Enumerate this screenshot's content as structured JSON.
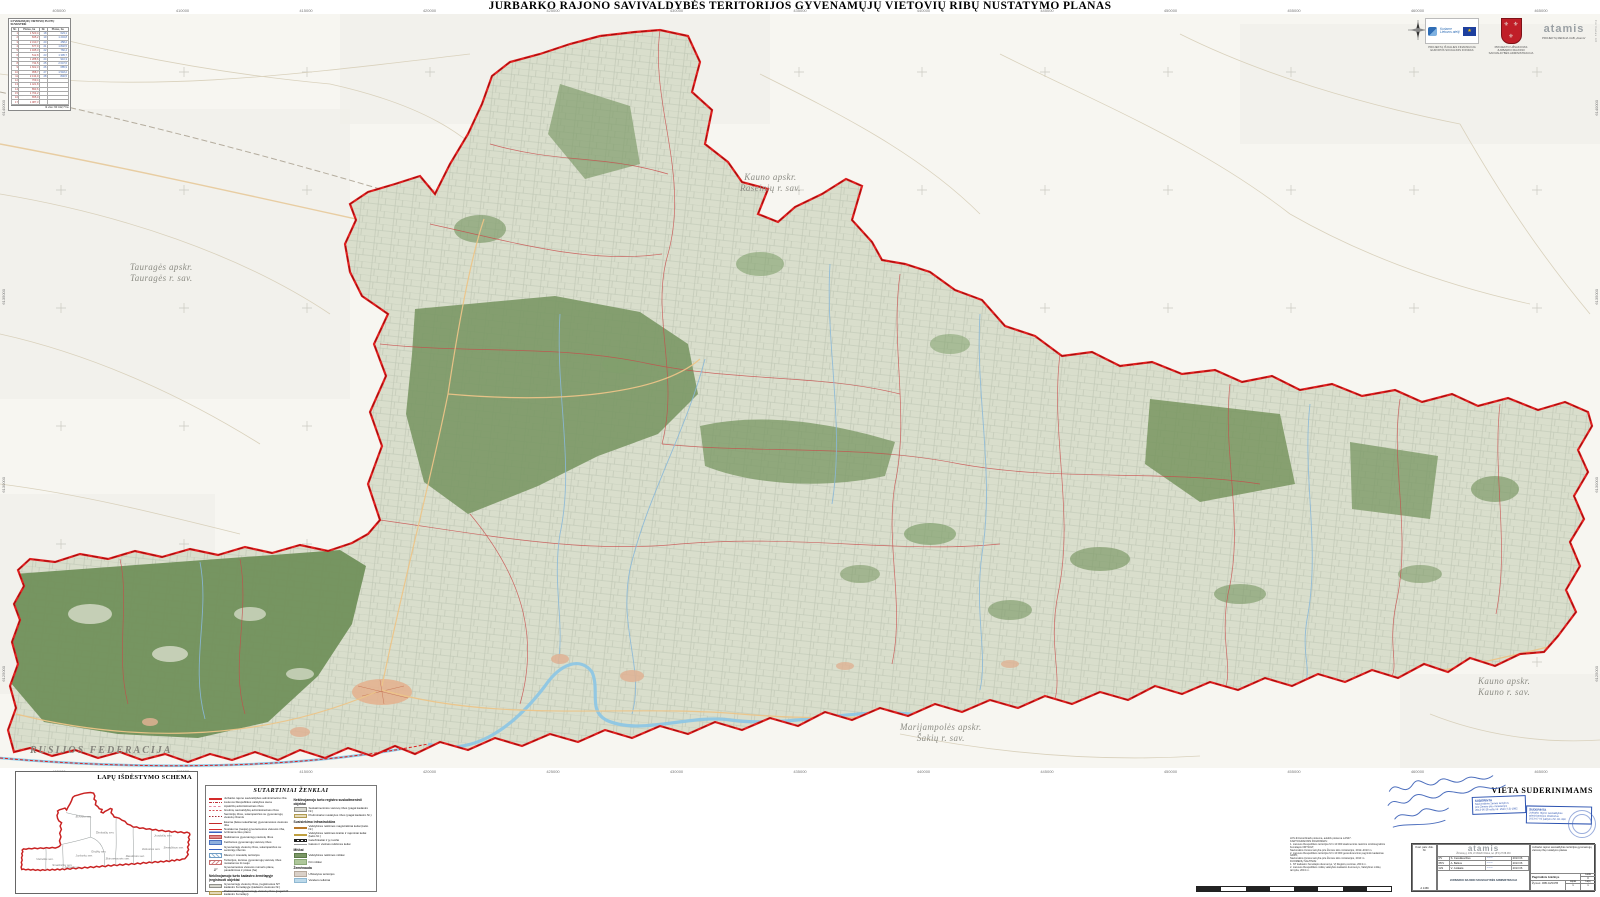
{
  "title": "JURBARKO RAJONO SAVIVALDYBĖS TERITORIJOS GYVENAMŲJŲ VIETOVIŲ RIBŲ NUSTATYMO PLANAS",
  "colors": {
    "boundary_red": "#e02020",
    "forest_green": "#7a9765",
    "parcel_base": "#d9decc",
    "water_blue": "#8ec6e4",
    "road_orange": "#ecc488",
    "stamp_blue": "#2b52b0",
    "herb_red": "#c01f28"
  },
  "grid": {
    "top": [
      "405000",
      "410000",
      "415000",
      "420000",
      "425000",
      "430000",
      "435000",
      "440000",
      "445000",
      "450000",
      "455000",
      "460000",
      "465000"
    ],
    "left_side": [
      "6140000",
      "6135000",
      "6130000",
      "6125000"
    ],
    "right_side": [
      "6140000",
      "6135000",
      "6130000",
      "6125000"
    ]
  },
  "map_labels": {
    "kauno_raseiniu_1": "Kauno apskr.",
    "kauno_raseiniu_2": "Raseinių r. sav.",
    "taurages_1": "Tauragės apskr.",
    "taurages_2": "Tauragės r. sav.",
    "rusijos": "RUSIJOS FEDERACIJA",
    "marijampoles_1": "Marijampolės apskr.",
    "marijampoles_2": "Šakių r. sav.",
    "kauno_kauno_1": "Kauno apskr.",
    "kauno_kauno_2": "Kauno r. sav."
  },
  "corner_table": {
    "title": "GYVENAMŲJŲ VIETOVIŲ PLOTŲ SUVESTINĖ",
    "headers": [
      "Nr.",
      "Plotas, ha",
      "Nr.",
      "Plotas, ha"
    ],
    "rows": [
      [
        "1",
        "1 523,4",
        "18",
        "623,1"
      ],
      [
        "2",
        "845,2",
        "19",
        "1 204,8"
      ],
      [
        "3",
        "2 310,7",
        "20",
        "458,2"
      ],
      [
        "4",
        "677,9",
        "21",
        "1 832,5"
      ],
      [
        "5",
        "1 945,3",
        "22",
        "760,4"
      ],
      [
        "6",
        "512,8",
        "23",
        "1 395,7"
      ],
      [
        "7",
        "1 288,6",
        "24",
        "910,3"
      ],
      [
        "8",
        "734,5",
        "25",
        "2 047,6"
      ],
      [
        "9",
        "1 602,3",
        "26",
        "685,9"
      ],
      [
        "10",
        "958,7",
        "27",
        "1 518,2"
      ],
      [
        "11",
        "2 134,9",
        "28",
        "846,5"
      ],
      [
        "12",
        "769,4",
        "",
        ""
      ],
      [
        "13",
        "1 421,8",
        "",
        ""
      ],
      [
        "14",
        "893,6",
        "",
        ""
      ],
      [
        "15",
        "1 764,2",
        "",
        ""
      ],
      [
        "16",
        "655,0",
        "",
        ""
      ],
      [
        "17",
        "1 087,3",
        "",
        ""
      ]
    ],
    "footer": "Iš viso: 60 412,7 ha"
  },
  "logos": {
    "eu_text": "Kuriame Lietuvos ateitį",
    "eu_caption": "PROJEKTĄ IŠ DALIES FINANSUOJA EUROPOS SOCIALINIS FONDAS",
    "herb_caption": "PROJEKTO UŽSAKOVAS JURBARKO RAJONO SAVIVALDYBĖS ADMINISTRACIJA",
    "atamis_name": "atamis",
    "atamis_caption": "PROJEKTĄ RENGIA UAB „Atamis“",
    "edge_note": "Formatas A0"
  },
  "schema": {
    "title": "LAPŲ IŠDĖSTYMO SCHEMA",
    "labels": [
      {
        "x": 150,
        "y": 650,
        "label": "Viešvilės sen."
      },
      {
        "x": 300,
        "y": 705,
        "label": "Smalininkų sen."
      },
      {
        "x": 415,
        "y": 725,
        "label": "Jurbarko m."
      },
      {
        "x": 520,
        "y": 615,
        "label": "Jurbarkų sen."
      },
      {
        "x": 665,
        "y": 580,
        "label": "Girdžių sen."
      },
      {
        "x": 800,
        "y": 645,
        "label": "Skirsnemunės sen."
      },
      {
        "x": 990,
        "y": 620,
        "label": "Raudonės sen."
      },
      {
        "x": 1140,
        "y": 555,
        "label": "Veliuonos sen."
      },
      {
        "x": 1345,
        "y": 540,
        "label": "Seredžiaus sen."
      },
      {
        "x": 1255,
        "y": 430,
        "label": "Juodaičių sen."
      },
      {
        "x": 710,
        "y": 400,
        "label": "Šimkaičių sen."
      },
      {
        "x": 520,
        "y": 250,
        "label": "Eržvilko sen."
      }
    ]
  },
  "legend": {
    "title": "SUTARTINIAI ŽENKLAI",
    "left": [
      {
        "cls": "sw-muni",
        "label": "Jurbarko rajono savivaldybės administracinė riba"
      },
      {
        "cls": "sw-state",
        "label": "Lietuvos Respublikos valstybės siena"
      },
      {
        "cls": "sw-county",
        "label": "Apskričių administracinės ribos"
      },
      {
        "cls": "sw-neigh",
        "label": "Gretimų savivaldybių administracinės ribos"
      },
      {
        "cls": "sw-eld",
        "label": "Seniūnijų ribos, sutampančios su gyvenamųjų vietovių ribomis"
      },
      {
        "cls": "sw-exist",
        "label": "Esama (lieka nekeičiama) gyvenamosios vietovės riba"
      },
      {
        "cls": "sw-new",
        "label": "Nustatoma (nauja) gyvenamosios vietovės riba, tvirtinama šiuo planu"
      },
      {
        "cls": "sw-del",
        "label": "Naikinamos gyvenamųjų vietovių ribos"
      },
      {
        "cls": "sw-chg",
        "label": "Keičiamos gyvenamųjų vietovių ribos"
      },
      {
        "cls": "sw-eldline",
        "label": "Gyvenamųjų vietovių ribos, sutampančios su seniūnijų ribomis"
      },
      {
        "cls": "sw-hatchb",
        "label": "Miestų ir miestelių teritorijos"
      },
      {
        "cls": "sw-hatchr",
        "label": "Teritorijos, kuriose gyvenamųjų vietovių ribos nustatomos iš naujo"
      },
      {
        "cls": "sw-num",
        "sym": "1²",
        "label": "Gyvenamosios vietovės numeris plane, pavadinimas ir plotas (ha)"
      }
    ],
    "left_sub_header": "Nekilnojamojo turto kadastro žemėlapyje įregistruoti objektai",
    "left_sub": [
      {
        "cls": "sw-regband",
        "label": "Gyvenamųjų vietovių ribos, įregistruotos NT kadastro žemėlapyje (kadastro vietovės Nr.)"
      },
      {
        "cls": "sw-prelband",
        "label": "Preliminarios gyvenamųjų vietovių ribos (pagal NT kadastro žemėlapį)"
      }
    ],
    "right_sub_header": "Nekilnojamojo turto registro suskaitmeninti objektai",
    "right_sub": [
      {
        "cls": "sw-regband",
        "label": "Suskaitmenintos vietovių ribos (pagal kadastro Nr.)"
      },
      {
        "cls": "sw-prelband",
        "label": "Preliminariai nustatytos ribos (pagal kadastro Nr.)"
      }
    ],
    "infra_header": "Susisiekimo infrastruktūra",
    "infra": [
      {
        "cls": "sw-roadA",
        "label": "Valstybinės reikšmės magistraliniai keliai (kelio Nr.)"
      },
      {
        "cls": "sw-roadK",
        "label": "Valstybinės reikšmės krašto ir rajoniniai keliai (kelio Nr.)"
      },
      {
        "cls": "sw-rail",
        "label": "Geležinkeliai ir jų ruožai"
      },
      {
        "cls": "sw-street",
        "label": "Gatvės ir vietinės reikšmės keliai"
      }
    ],
    "forest_header": "Miškai",
    "forest": [
      {
        "cls": "sw-forest1",
        "label": "Valstybinės reikšmės miškai"
      },
      {
        "cls": "sw-forest2",
        "label": "Kiti miškai"
      }
    ],
    "land_header": "Žemėnauda",
    "land": [
      {
        "cls": "sw-built",
        "label": "Užstatytos teritorijos"
      },
      {
        "cls": "sw-water",
        "label": "Vandens telkiniai"
      }
    ]
  },
  "notes": {
    "lines": [
      "LKS-94 koordinačių sistema, aukščių sistema LAS07.",
      "KARTOGRAFINIS PAGRINDAS:",
      "1. Lietuvos Respublikos teritorijos M 1:10 000 skaitmeninis rastrinis ortofotografinis žemėlapis ORT10LT,",
      "Nacionalinė žemės tarnyba prie Žemės ūkio ministerijos, 2012–2013 m.",
      "2. Lietuvos Respublikos teritorijos M 1:10 000 georeferencinio pagrindo kadastras GRPK,",
      "Nacionalinė žemės tarnyba prie Žemės ūkio ministerijos, 2013 m.",
      "DUOMENŲ ŠALTINIAI:",
      "1. NT kadastro žemėlapio duomenys, VĮ Registrų centras, 2013 m.",
      "2. Lietuvos Respublikos miškų valstybės kadastro duomenys, Valstybinė miškų tarnyba, 2013 m."
    ]
  },
  "approvals": {
    "title": "VIETA SUDERINIMAMS",
    "stamp1": {
      "head": "SUDERINTA",
      "lines": [
        "Nacionalinės žemės tarnybos",
        "prie Žemės ūkio ministerijos",
        "2013-06-28 raštu Nr. 1SD-(7.3)-1892"
      ]
    },
    "stamp2": {
      "head": "SUDERINTA",
      "lines": [
        "Jurbarko rajono savivaldybės",
        "administracijos direktorius",
        "2013-07-02 įsakymu Nr. O1-890"
      ]
    }
  },
  "titleblock": {
    "cert_label": "Kval. patv. dok. Nr.",
    "cert_no": "A 1469",
    "company": "atamis",
    "address": "Žirmūnų g. 139, LT-09120 Vilnius, tel. (8 5) 27 88 433",
    "rows": [
      {
        "role": "PV",
        "name": "S. Čereškevičius",
        "sig": "~~~",
        "date": "2013 06"
      },
      {
        "role": "PDV",
        "name": "A. Balkus",
        "sig": "~~~",
        "date": "2013 06"
      },
      {
        "role": "GIS",
        "name": "V. Juškaitė",
        "sig": "~~~",
        "date": "2013 06"
      }
    ],
    "client": "JURBARKO RAJONO SAVIVALDYBĖS ADMINISTRACIJA",
    "project": "Jurbarko rajono savivaldybės teritorijos gyvenamųjų vietovių ribų nustatymo planas",
    "drawing": "Pagrindinis brėžinys",
    "laida_label": "Laida",
    "laida": "0",
    "code_label": "Žymuo:",
    "code": "JRB-GVR-PB",
    "lapas_label": "Lapas",
    "lapas": "1",
    "lapu_label": "Lapų",
    "lapu": "1"
  }
}
